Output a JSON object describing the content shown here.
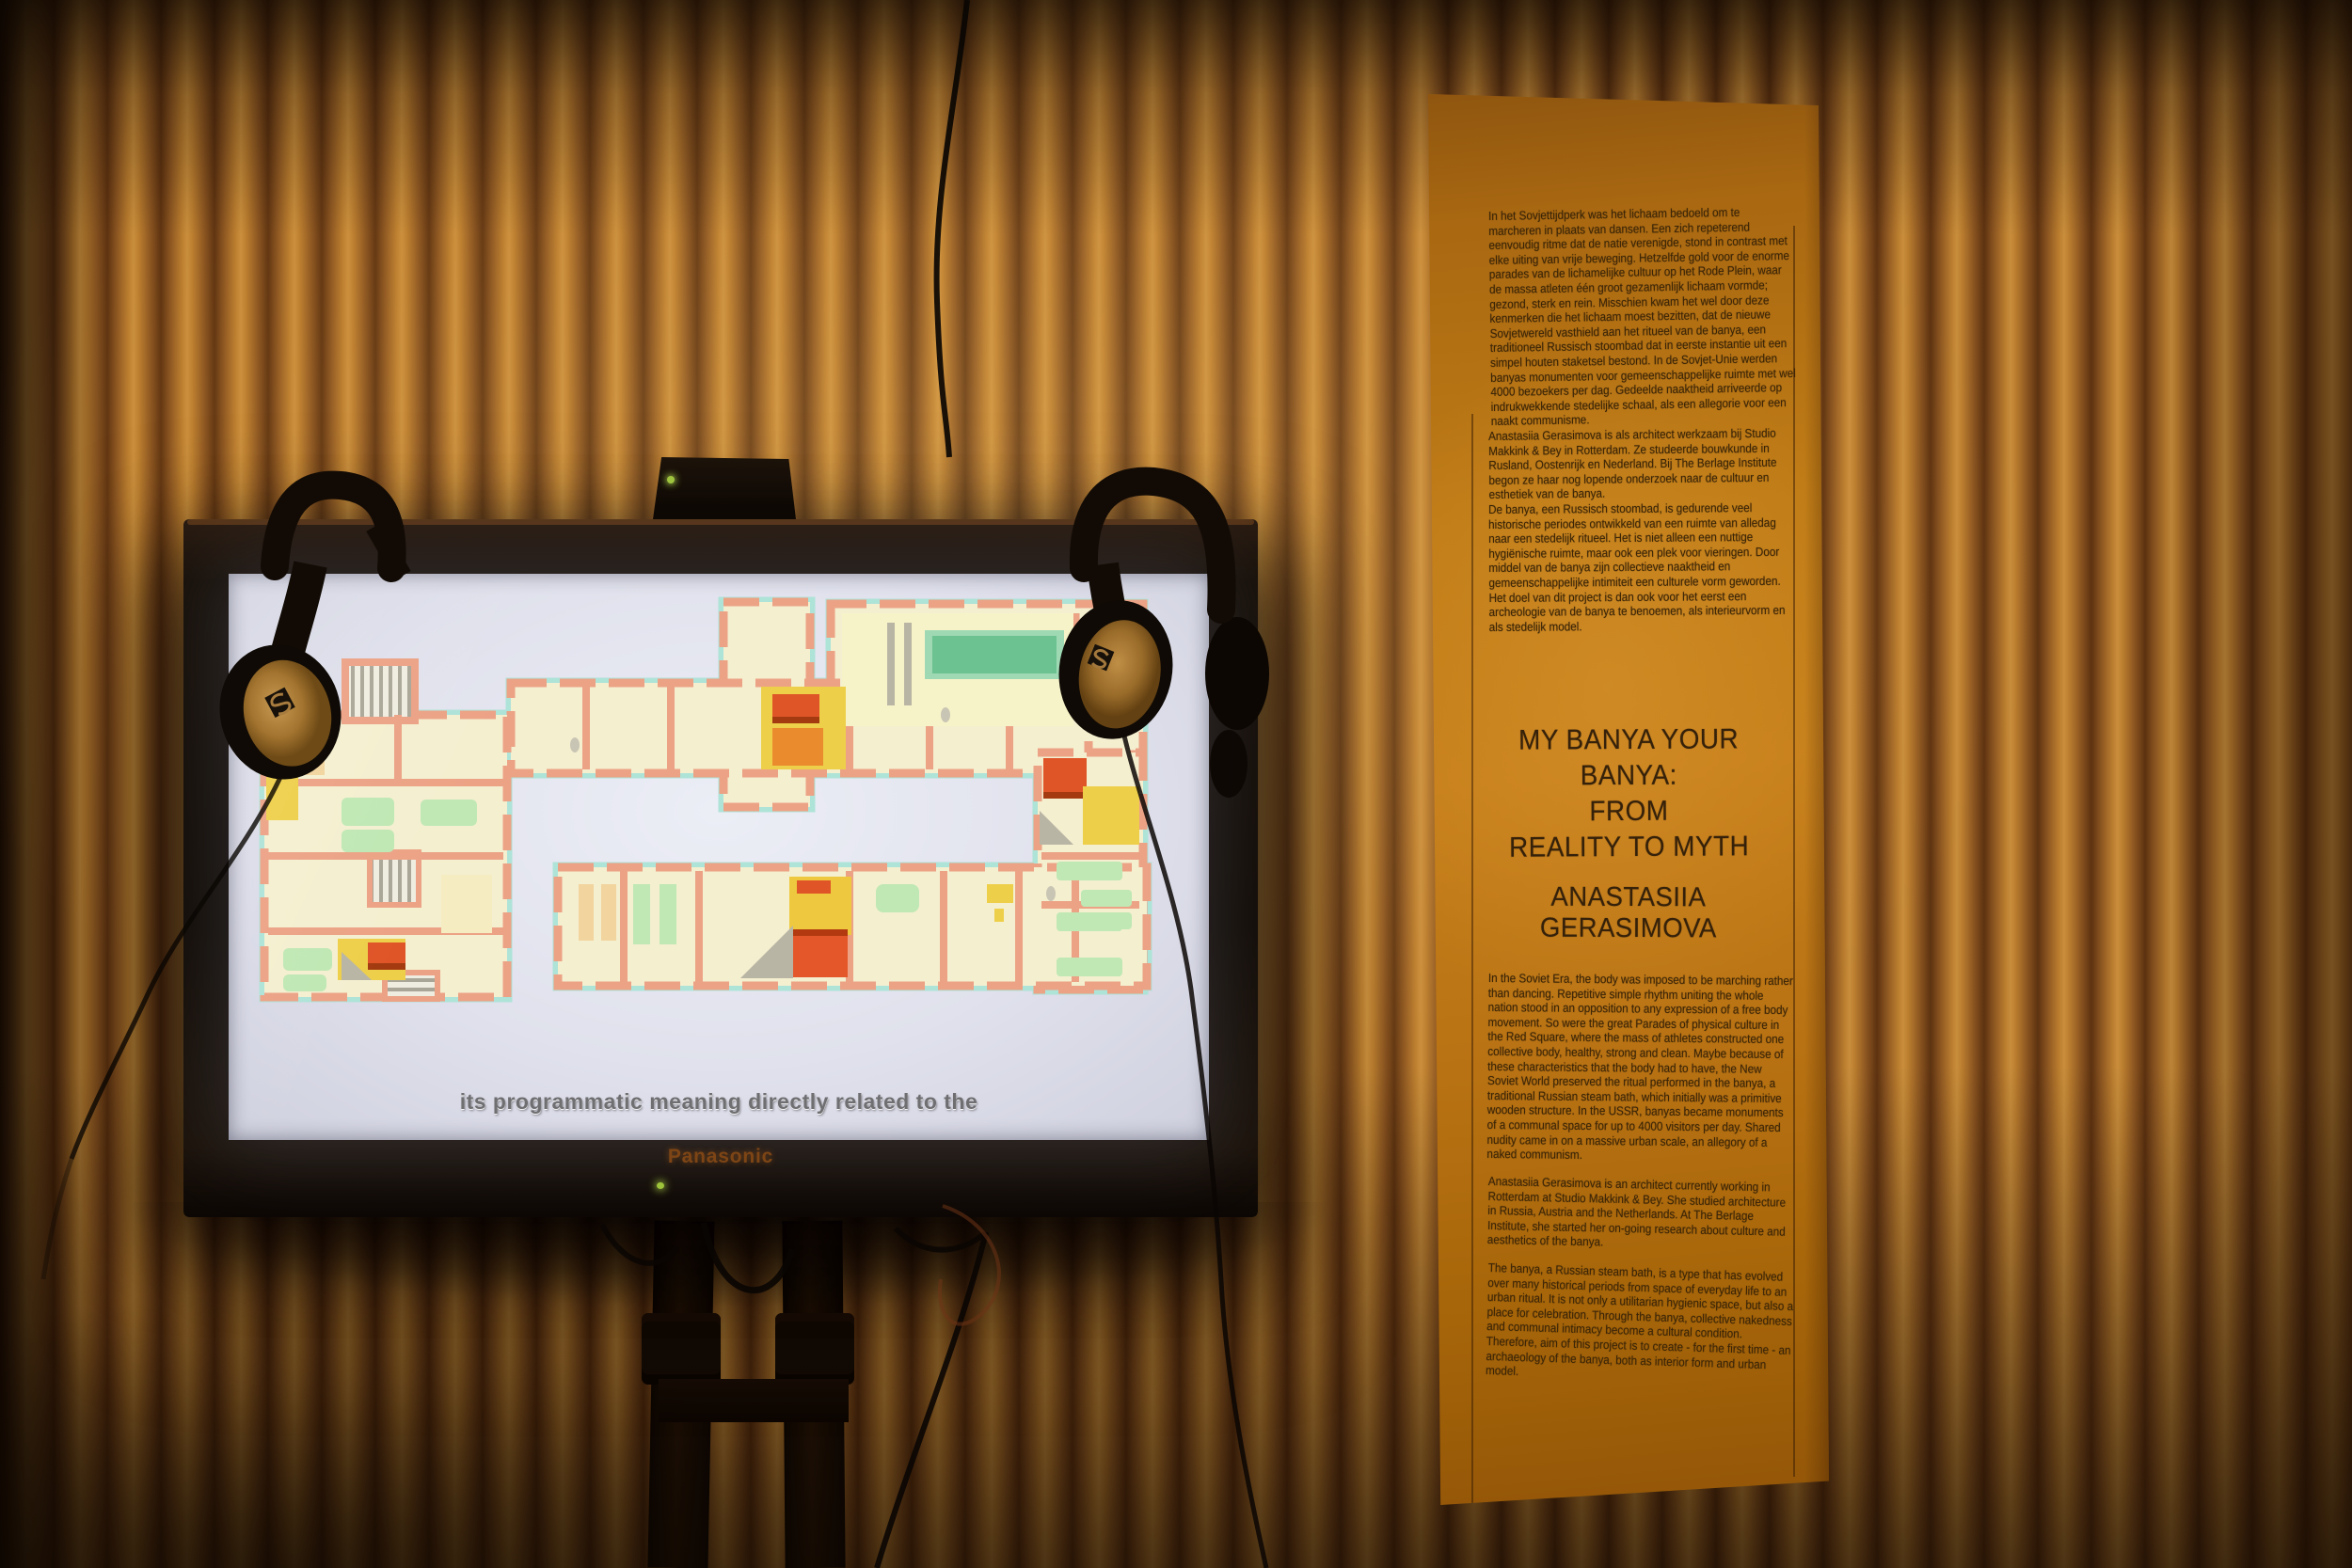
{
  "scene": {
    "description": "exhibition installation: TV on stand with two headphones, poster on corrugated wall",
    "wall_colors": {
      "highlight": "#c98e3c",
      "mid": "#8a5420",
      "shadow": "#5d3210"
    }
  },
  "tv": {
    "brand_label": "Panasonic",
    "subtitle": "its programmatic meaning directly related to the",
    "bezel_color": "#17100a",
    "screen_color": "#e0e1ec",
    "power_led_color": "#9dc43b",
    "floorplan_colors": {
      "walls": "#eca285",
      "rooms": "#f4efcf",
      "pool": "#6cc291",
      "furniture_green": "#bfe8b4",
      "accent_yellow": "#eecf4a",
      "accent_orange": "#ea8c2e",
      "accent_red": "#e05528",
      "windows_teal": "#aee3d8",
      "stairs_gray": "#aaa697"
    }
  },
  "media_box": {
    "status_led_color": "#9ec43f"
  },
  "headphones": {
    "count": 2,
    "logo_icon": "sennheiser-s-logo",
    "pad_color": "#b98a45"
  },
  "poster": {
    "paper_color": "#c07c16",
    "text_color": "#3b2508",
    "dutch_paragraphs": [
      "In het Sovjettijdperk was het lichaam bedoeld om te marcheren in plaats van dansen. Een zich repeterend eenvoudig ritme dat de natie verenigde, stond in contrast met elke uiting van vrije beweging. Hetzelfde gold voor de enorme parades van de lichamelijke cultuur op het Rode Plein, waar de massa atleten één groot gezamenlijk lichaam vormde; gezond, sterk en rein. Misschien kwam het wel door deze kenmerken die het lichaam moest bezitten, dat de nieuwe Sovjetwereld vasthield aan het ritueel van de banya, een traditioneel Russisch stoombad dat in eerste instantie uit een simpel houten staketsel bestond. In de Sovjet-Unie werden banyas monumenten voor gemeenschappelijke ruimte met wel 4000 bezoekers per dag. Gedeelde naaktheid arriveerde op indrukwekkende stedelijke schaal, als een allegorie voor een naakt communisme.",
      "Anastasiia Gerasimova is als architect werkzaam bij Studio Makkink & Bey in Rotterdam. Ze studeerde bouwkunde in Rusland, Oostenrijk en Nederland. Bij The Berlage Institute begon ze haar nog lopende onderzoek naar de cultuur en esthetiek van de banya.",
      "De banya, een Russisch stoombad, is gedurende veel historische periodes ontwikkeld van een ruimte van alledag naar een stedelijk ritueel. Het is niet alleen een nuttige hygiënische ruimte, maar ook een plek voor vieringen. Door middel van de banya zijn collectieve naaktheid en gemeenschappelijke intimiteit een culturele vorm geworden. Het doel van dit project is dan ook voor het eerst een archeologie van de banya te benoemen, als interieurvorm en als stedelijk model."
    ],
    "title_lines": [
      "MY BANYA YOUR BANYA:",
      "FROM",
      "REALITY TO MYTH"
    ],
    "author": "ANASTASIIA GERASIMOVA",
    "english_paragraphs": [
      "In the Soviet Era, the body was imposed to be marching rather than dancing. Repetitive simple rhythm uniting the whole nation stood in an opposition to any expression of a free body movement. So were the great Parades of physical culture in the Red Square, where the mass of athletes constructed one collective body, healthy, strong and clean. Maybe because of these characteristics that the body had to have, the New Soviet World preserved the ritual performed in the banya, a traditional Russian steam bath, which initially was a primitive wooden structure. In the USSR, banyas became monuments of a communal space for up to 4000 visitors per day. Shared nudity came in on a massive urban scale, an allegory of a naked communism.",
      "Anastasiia Gerasimova is an architect currently working in Rotterdam at Studio Makkink & Bey. She studied architecture in Russia, Austria and the Netherlands. At The Berlage Institute, she started her on-going research about culture and aesthetics of the banya.",
      "The banya, a Russian steam bath, is a type that has evolved over many historical periods from space of everyday life to an urban ritual. It is not only a utilitarian hygienic space, but also a place for celebration. Through the banya, collective nakedness and communal intimacy become a cultural condition. Therefore, aim of this project is to create - for the first time - an archaeology of the banya, both as interior form and urban model."
    ]
  }
}
